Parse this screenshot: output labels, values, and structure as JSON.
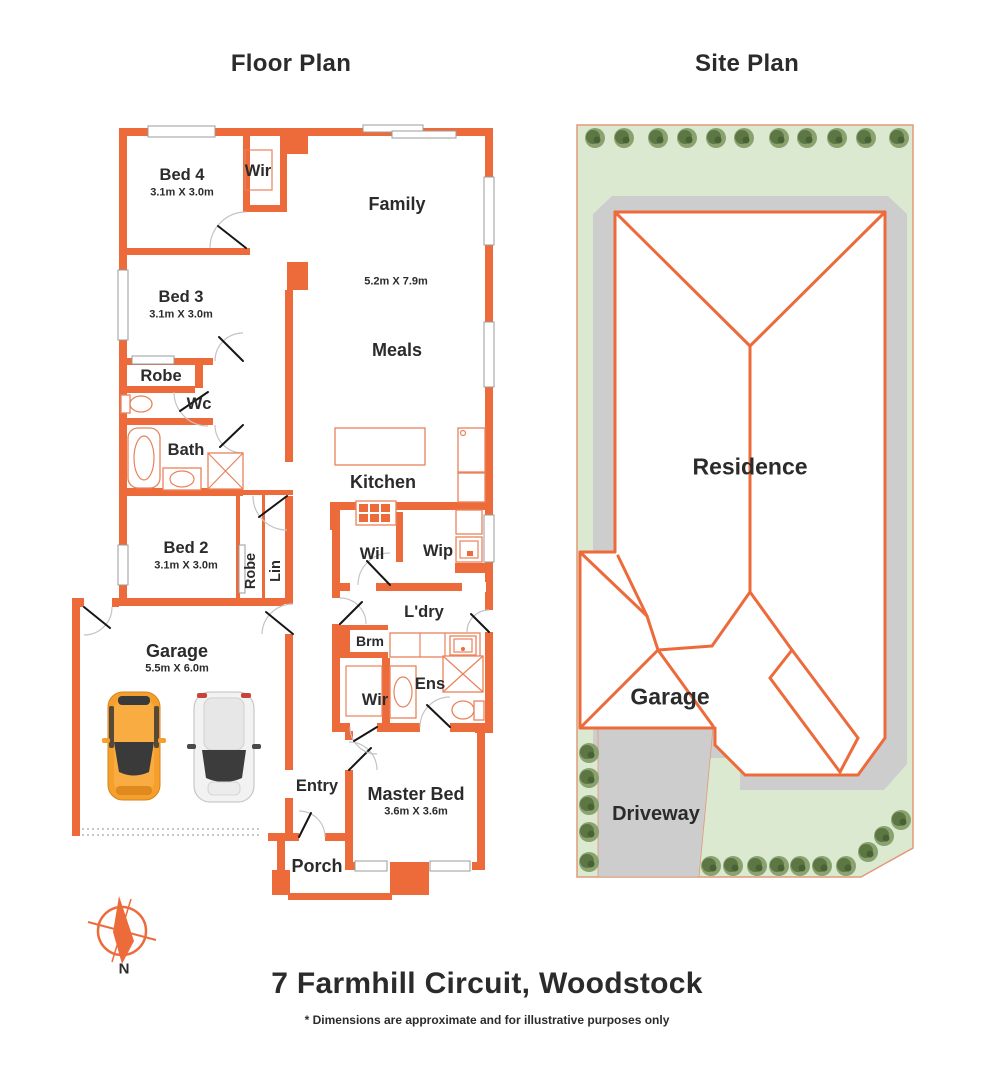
{
  "titles": {
    "floor_plan": "Floor Plan",
    "site_plan": "Site Plan"
  },
  "floor_plan": {
    "bed4": {
      "name": "Bed 4",
      "dims": "3.1m X 3.0m"
    },
    "wir_top": {
      "name": "Wir"
    },
    "family": {
      "name": "Family",
      "dims": "5.2m X 7.9m"
    },
    "bed3": {
      "name": "Bed 3",
      "dims": "3.1m X 3.0m"
    },
    "robe_bed3": {
      "name": "Robe"
    },
    "wc": {
      "name": "Wc"
    },
    "bath": {
      "name": "Bath"
    },
    "meals": {
      "name": "Meals"
    },
    "kitchen": {
      "name": "Kitchen"
    },
    "bed2": {
      "name": "Bed 2",
      "dims": "3.1m X 3.0m"
    },
    "robe_bed2": {
      "name": "Robe"
    },
    "lin": {
      "name": "Lin"
    },
    "wil": {
      "name": "Wil"
    },
    "wip": {
      "name": "Wip"
    },
    "ldry": {
      "name": "L'dry"
    },
    "brm": {
      "name": "Brm"
    },
    "wir_master": {
      "name": "Wir"
    },
    "ens": {
      "name": "Ens"
    },
    "garage": {
      "name": "Garage",
      "dims": "5.5m X 6.0m"
    },
    "entry": {
      "name": "Entry"
    },
    "master_bed": {
      "name": "Master Bed",
      "dims": "3.6m X 3.6m"
    },
    "porch": {
      "name": "Porch"
    }
  },
  "site_plan": {
    "residence": "Residence",
    "garage": "Garage",
    "driveway": "Driveway"
  },
  "compass": {
    "north_label": "N"
  },
  "footer": {
    "address": "7 Farmhill Circuit, Woodstock",
    "disclaimer": "* Dimensions are approximate and for illustrative purposes only"
  },
  "colors": {
    "wall_orange": "#ED6A3B",
    "fixture_orange": "#E9825B",
    "lawn_green": "#DCE9D1",
    "path_gray": "#CDCDCD",
    "tree_green": "#5C7744",
    "boundary_line": "#E09A78",
    "text": "#2B2B2B",
    "car_orange": "#F5A02D"
  }
}
